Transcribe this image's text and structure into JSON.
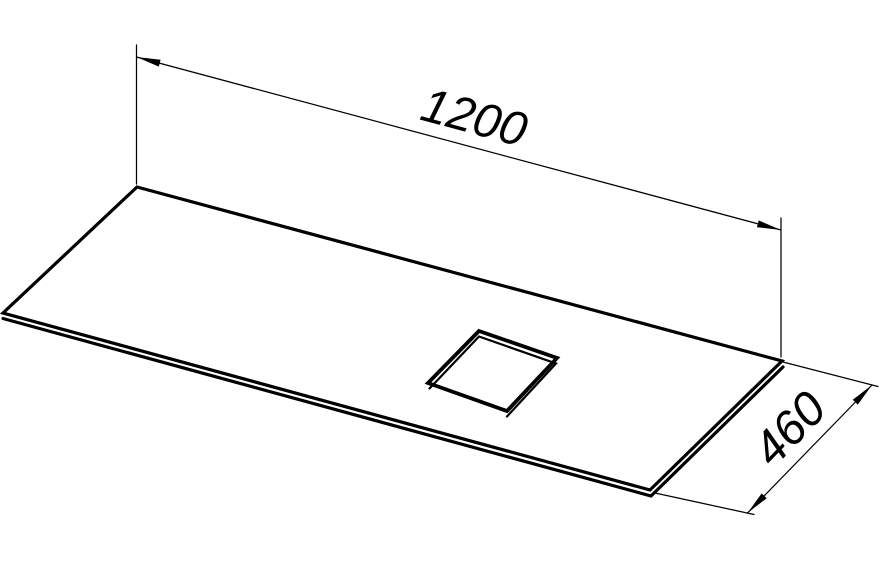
{
  "page": {
    "background_color": "#ffffff",
    "line_color": "#000000"
  },
  "drawing": {
    "description": "Isometric technical line drawing of a flat rectangular panel (countertop) with a square cutout opening",
    "dimensions": {
      "length": {
        "label": "1200"
      },
      "depth": {
        "label": "460"
      }
    }
  }
}
